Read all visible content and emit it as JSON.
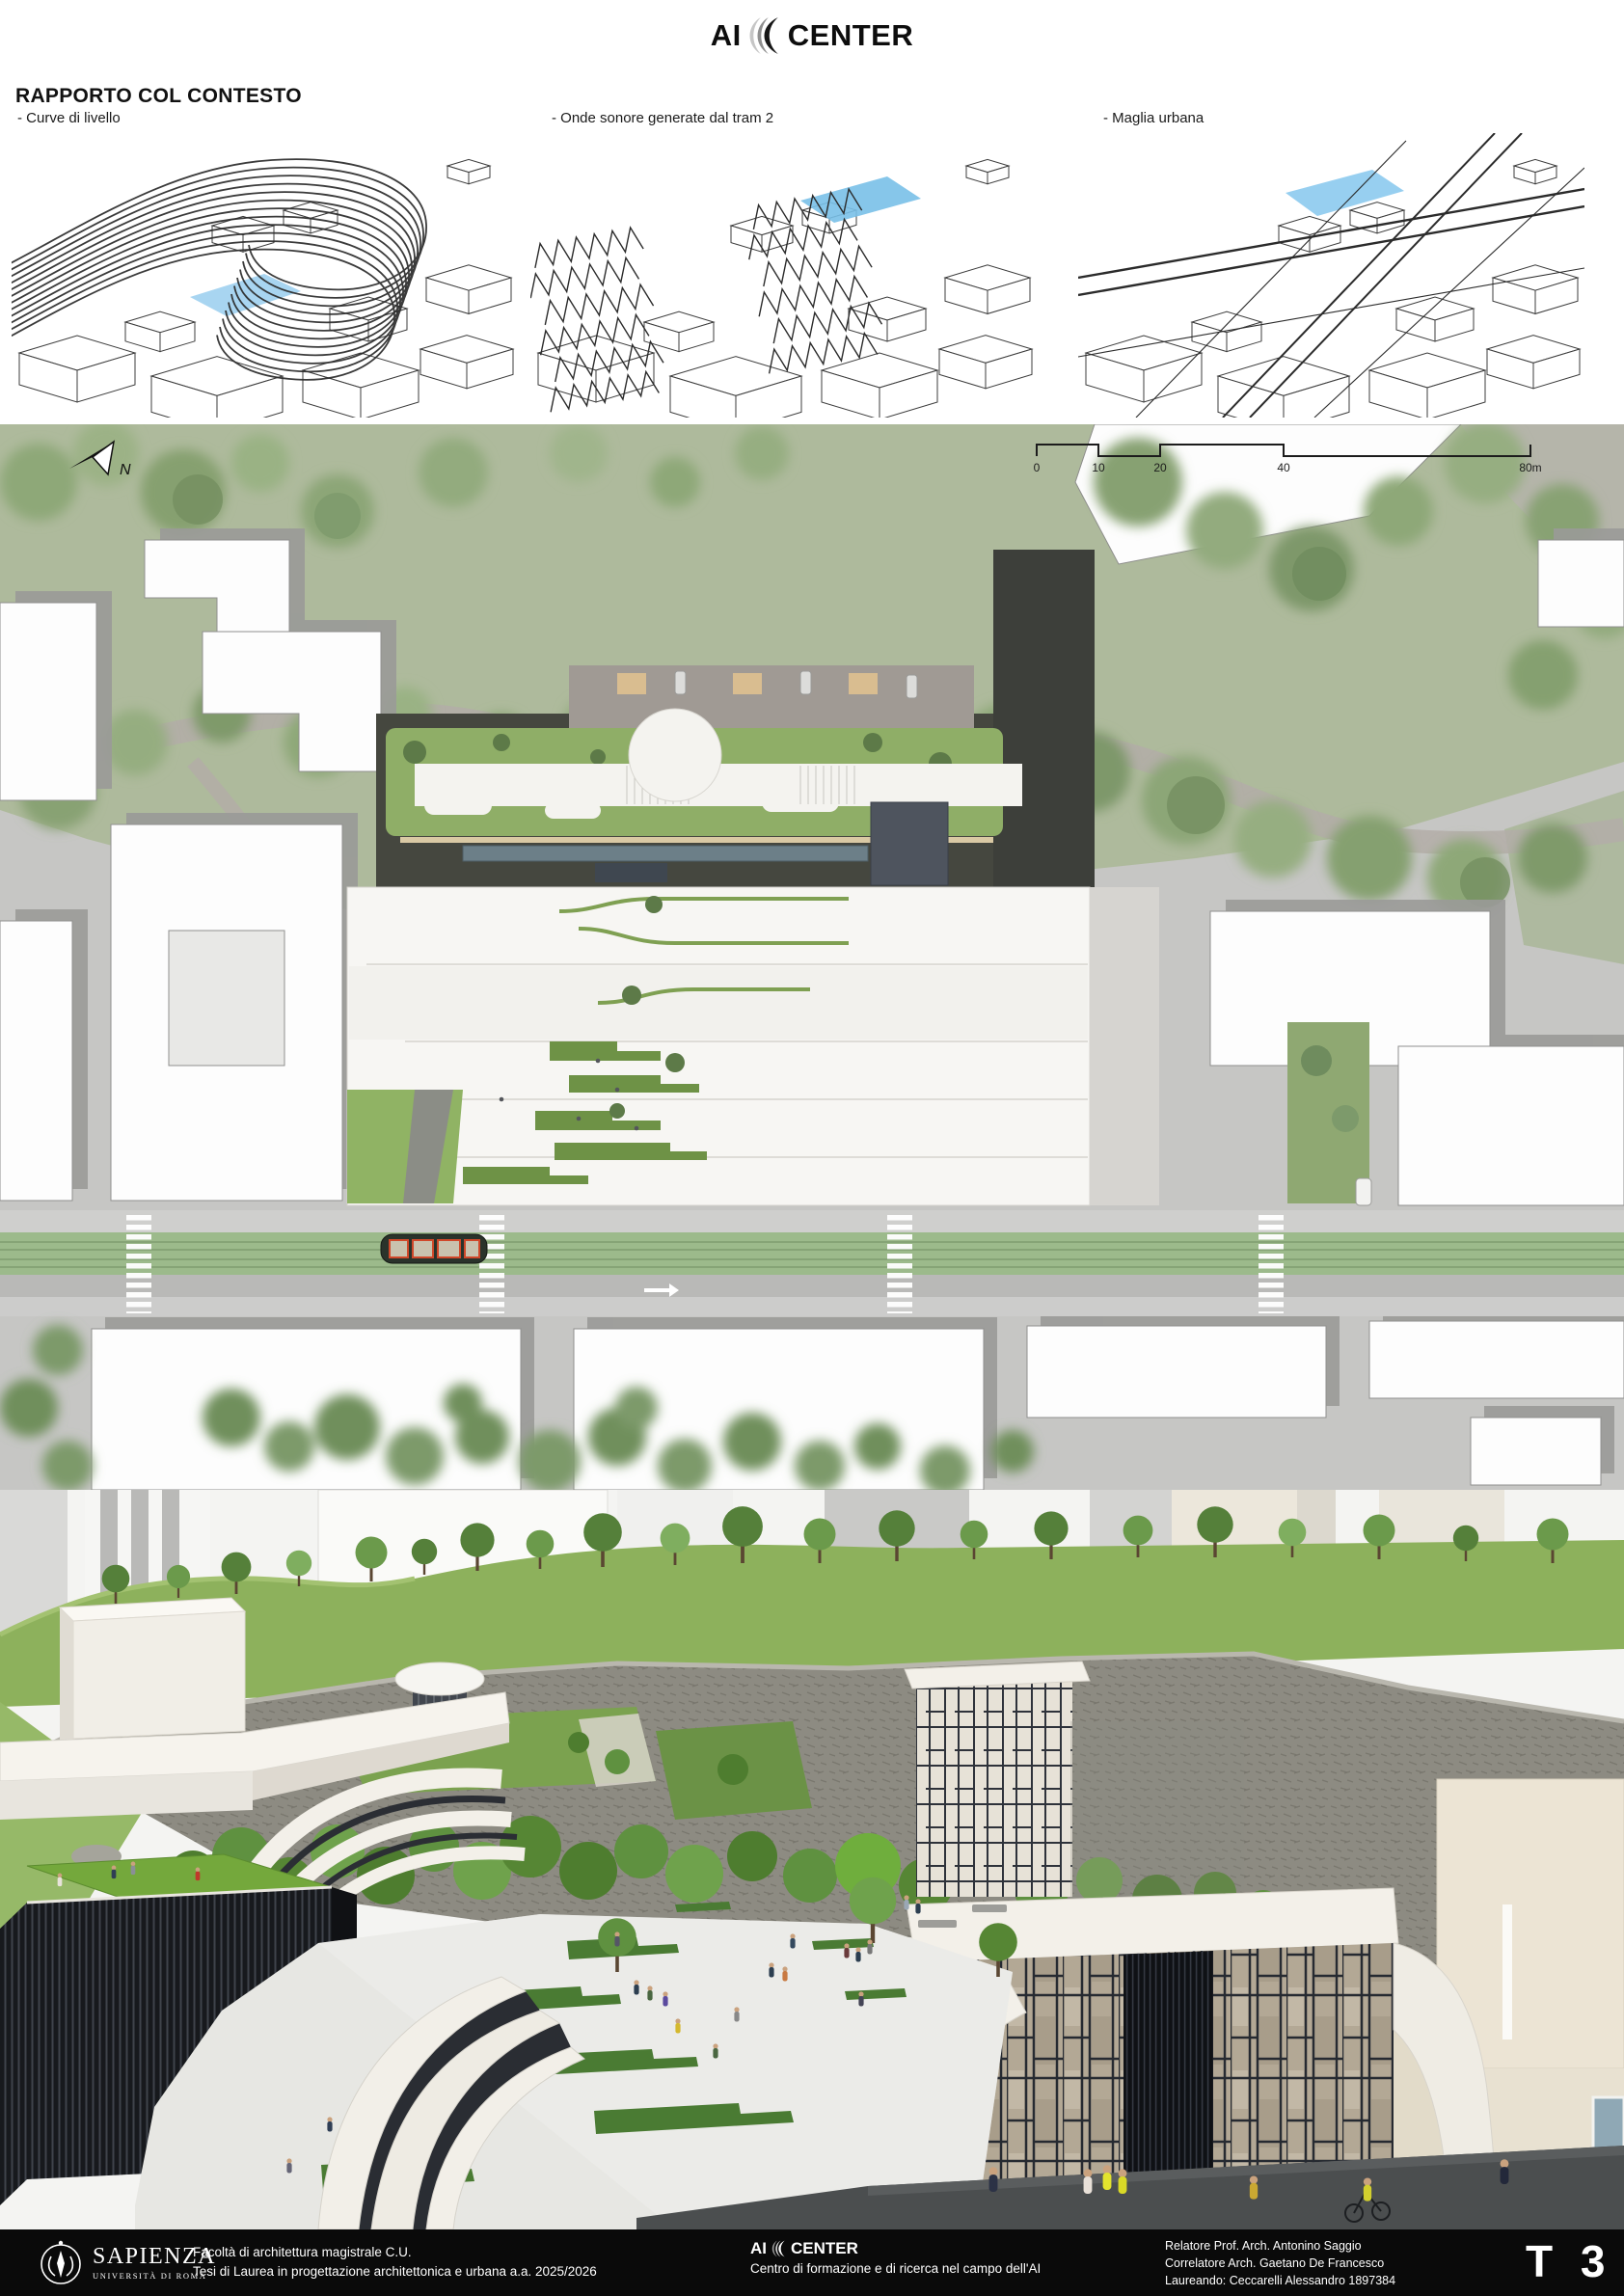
{
  "header": {
    "logo_left": "AI",
    "logo_right": "CENTER",
    "title": "RAPPORTO COL CONTESTO"
  },
  "diagrams": [
    {
      "label": "- Curve di livello"
    },
    {
      "label": "- Onde sonore generate dal tram 2"
    },
    {
      "label": "- Maglia urbana"
    }
  ],
  "site_plan": {
    "north_label": "N",
    "scale_bar": {
      "ticks": [
        "0",
        "10",
        "20",
        "40",
        "80m"
      ]
    }
  },
  "footer": {
    "university_name": "SAPIENZA",
    "university_subtitle": "UNIVERSITÀ DI ROMA",
    "faculty_line1": "Facoltà di architettura magistrale C.U.",
    "faculty_line2": "Tesi di Laurea in progettazione architettonica e urbana a.a. 2025/2026",
    "project_logo_left": "AI",
    "project_logo_right": "CENTER",
    "project_subtitle": "Centro di formazione e di ricerca nel campo dell'AI",
    "credit_line1": "Relatore Prof. Arch. Antonino Saggio",
    "credit_line2": "Correlatore Arch. Gaetano De Francesco",
    "credit_line3": "Laureando: Ceccarelli Alessandro  1897384",
    "sheet_number": "T 3"
  },
  "colors": {
    "highlight_blue": "#8ec9ec",
    "park_green": "#aeba9c",
    "tram_green": "#9cba8b",
    "roof_lawn_green": "#76a93e",
    "slate_volume": "#4e545e",
    "footer_bg": "#0a0a0a"
  }
}
